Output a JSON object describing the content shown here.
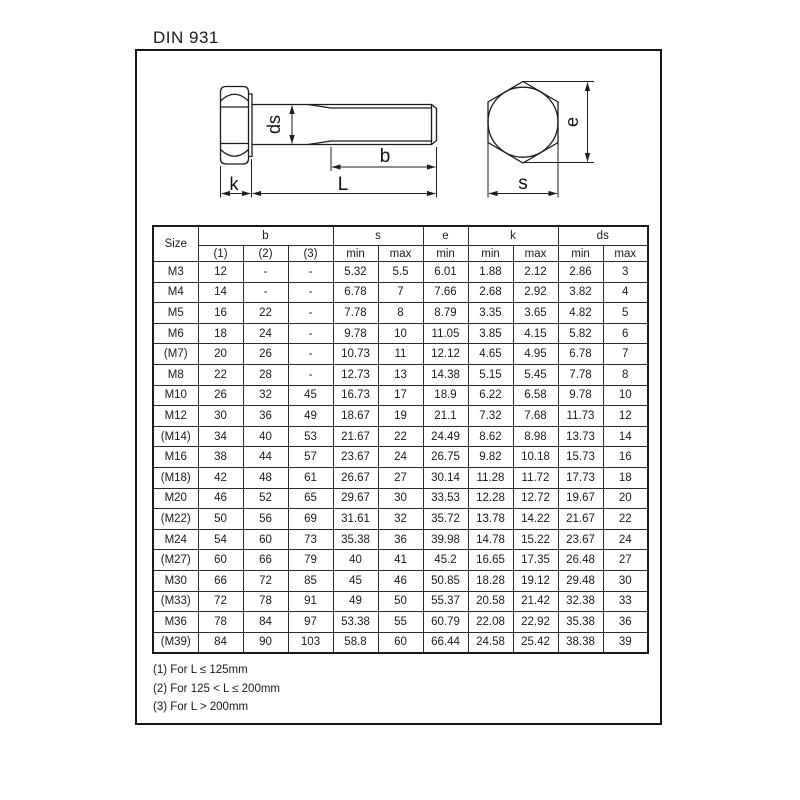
{
  "page": {
    "title": "DIN 931"
  },
  "drawing": {
    "labels": {
      "ds": "ds",
      "b": "b",
      "k": "k",
      "L": "L",
      "e": "e",
      "s": "s"
    }
  },
  "table": {
    "size_header": "Size",
    "groups": [
      {
        "label": "b",
        "subs": [
          "(1)",
          "(2)",
          "(3)"
        ]
      },
      {
        "label": "s",
        "subs": [
          "min",
          "max"
        ]
      },
      {
        "label": "e",
        "subs": [
          "min"
        ]
      },
      {
        "label": "k",
        "subs": [
          "min",
          "max"
        ]
      },
      {
        "label": "ds",
        "subs": [
          "min",
          "max"
        ]
      }
    ],
    "rows": [
      [
        "M3",
        "12",
        "-",
        "-",
        "5.32",
        "5.5",
        "6.01",
        "1.88",
        "2.12",
        "2.86",
        "3"
      ],
      [
        "M4",
        "14",
        "-",
        "-",
        "6.78",
        "7",
        "7.66",
        "2.68",
        "2.92",
        "3.82",
        "4"
      ],
      [
        "M5",
        "16",
        "22",
        "-",
        "7.78",
        "8",
        "8.79",
        "3.35",
        "3.65",
        "4.82",
        "5"
      ],
      [
        "M6",
        "18",
        "24",
        "-",
        "9.78",
        "10",
        "11.05",
        "3.85",
        "4.15",
        "5.82",
        "6"
      ],
      [
        "(M7)",
        "20",
        "26",
        "-",
        "10.73",
        "11",
        "12.12",
        "4.65",
        "4.95",
        "6.78",
        "7"
      ],
      [
        "M8",
        "22",
        "28",
        "-",
        "12.73",
        "13",
        "14.38",
        "5.15",
        "5.45",
        "7.78",
        "8"
      ],
      [
        "M10",
        "26",
        "32",
        "45",
        "16.73",
        "17",
        "18.9",
        "6.22",
        "6.58",
        "9.78",
        "10"
      ],
      [
        "M12",
        "30",
        "36",
        "49",
        "18.67",
        "19",
        "21.1",
        "7.32",
        "7.68",
        "11.73",
        "12"
      ],
      [
        "(M14)",
        "34",
        "40",
        "53",
        "21.67",
        "22",
        "24.49",
        "8.62",
        "8.98",
        "13.73",
        "14"
      ],
      [
        "M16",
        "38",
        "44",
        "57",
        "23.67",
        "24",
        "26.75",
        "9.82",
        "10.18",
        "15.73",
        "16"
      ],
      [
        "(M18)",
        "42",
        "48",
        "61",
        "26.67",
        "27",
        "30.14",
        "11.28",
        "11.72",
        "17.73",
        "18"
      ],
      [
        "M20",
        "46",
        "52",
        "65",
        "29.67",
        "30",
        "33.53",
        "12.28",
        "12.72",
        "19.67",
        "20"
      ],
      [
        "(M22)",
        "50",
        "56",
        "69",
        "31.61",
        "32",
        "35.72",
        "13.78",
        "14.22",
        "21.67",
        "22"
      ],
      [
        "M24",
        "54",
        "60",
        "73",
        "35.38",
        "36",
        "39.98",
        "14.78",
        "15.22",
        "23.67",
        "24"
      ],
      [
        "(M27)",
        "60",
        "66",
        "79",
        "40",
        "41",
        "45.2",
        "16.65",
        "17.35",
        "26.48",
        "27"
      ],
      [
        "M30",
        "66",
        "72",
        "85",
        "45",
        "46",
        "50.85",
        "18.28",
        "19.12",
        "29.48",
        "30"
      ],
      [
        "(M33)",
        "72",
        "78",
        "91",
        "49",
        "50",
        "55.37",
        "20.58",
        "21.42",
        "32.38",
        "33"
      ],
      [
        "M36",
        "78",
        "84",
        "97",
        "53.38",
        "55",
        "60.79",
        "22.08",
        "22.92",
        "35.38",
        "36"
      ],
      [
        "(M39)",
        "84",
        "90",
        "103",
        "58.8",
        "60",
        "66.44",
        "24.58",
        "25.42",
        "38.38",
        "39"
      ]
    ]
  },
  "footnotes": [
    "(1) For L ≤ 125mm",
    "(2) For 125 < L ≤ 200mm",
    "(3) For L > 200mm"
  ]
}
